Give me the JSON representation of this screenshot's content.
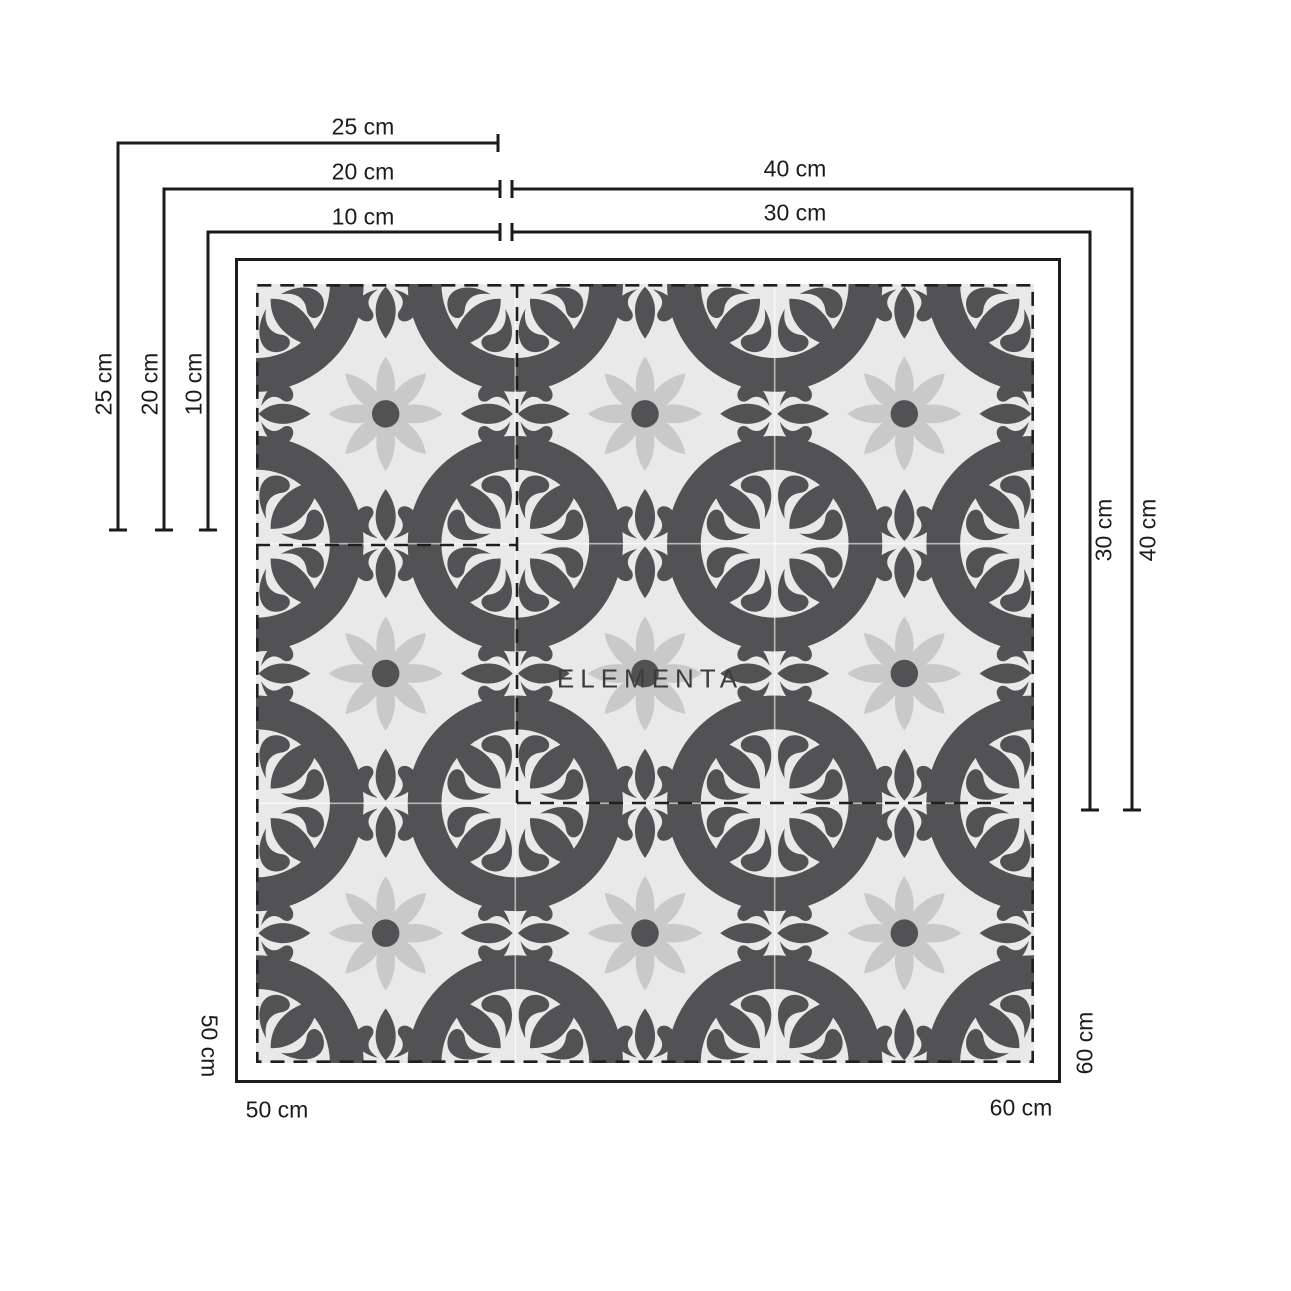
{
  "watermark": "ELEMENTA",
  "colors": {
    "pattern_dark": "#525254",
    "pattern_bg": "#e9e9e9",
    "petal": "#c9c9c9",
    "line": "#1b1b1b",
    "page_bg": "#ffffff"
  },
  "dimensions": {
    "top": {
      "d25": "25 cm",
      "d20": "20 cm",
      "d10": "10 cm",
      "d40": "40 cm",
      "d30": "30 cm"
    },
    "left": {
      "d25": "25 cm",
      "d20": "20 cm",
      "d10": "10 cm"
    },
    "right": {
      "d30": "30 cm",
      "d40": "40 cm"
    },
    "bottom": {
      "left_width": "50 cm",
      "left_height": "50 cm",
      "right_width": "60 cm",
      "right_height": "60 cm"
    }
  }
}
